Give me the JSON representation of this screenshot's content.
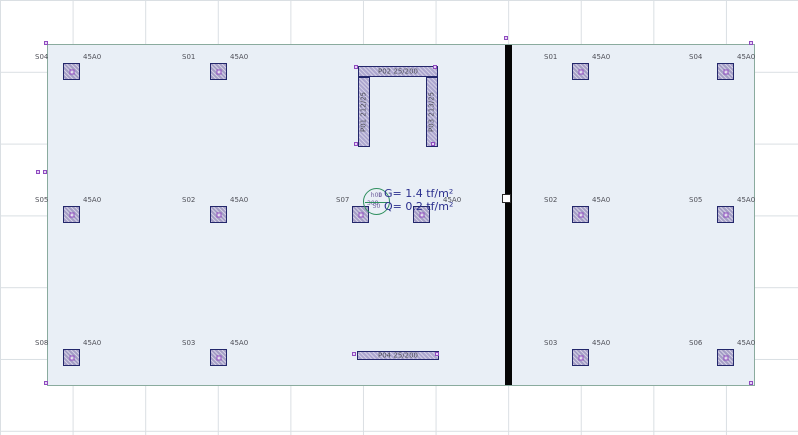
{
  "canvas": {
    "width": 798,
    "height": 435,
    "background": "#ffffff",
    "grid_color": "#dadfe3"
  },
  "slab": {
    "fill": "#e9eff6",
    "border_color": "#8aab9e"
  },
  "divider_wall": {
    "color": "#050505"
  },
  "accent_colors": {
    "entity_fill": "#a49ec6",
    "entity_border": "#23276b",
    "node_marker_purple": "#8f4bbf",
    "label_gray": "#4f5058",
    "load_text_blue": "#2b2f8e",
    "slab_tag_green": "#2e8f5e"
  },
  "loads": {
    "g": "G= 1.4 tf/m²",
    "q": "Q= 0.2 tf/m²"
  },
  "slab_tag": {
    "line1": "h00",
    "line2": "50"
  },
  "columns": [
    {
      "name": "S04",
      "section": "45A0",
      "x": 63,
      "y": 63
    },
    {
      "name": "S01",
      "section": "45A0",
      "x": 210,
      "y": 63
    },
    {
      "name": "S05",
      "section": "45A0",
      "x": 63,
      "y": 206
    },
    {
      "name": "S02",
      "section": "45A0",
      "x": 210,
      "y": 206
    },
    {
      "name": "S07",
      "section": null,
      "x": 352,
      "y": 206,
      "name_dx": -16
    },
    {
      "name": null,
      "section": "45A0",
      "x": 413,
      "y": 206,
      "section_dx": 30
    },
    {
      "name": "S08",
      "section": "45A0",
      "x": 63,
      "y": 349
    },
    {
      "name": "S03",
      "section": "45A0",
      "x": 210,
      "y": 349
    },
    {
      "name": "S01",
      "section": "45A0",
      "x": 572,
      "y": 63
    },
    {
      "name": "S04",
      "section": "45A0",
      "x": 717,
      "y": 63
    },
    {
      "name": "S02",
      "section": "45A0",
      "x": 572,
      "y": 206
    },
    {
      "name": "S05",
      "section": "45A0",
      "x": 717,
      "y": 206
    },
    {
      "name": "S03",
      "section": "45A0",
      "x": 572,
      "y": 349
    },
    {
      "name": "S06",
      "section": "45A0",
      "x": 717,
      "y": 349
    }
  ],
  "walls": [
    {
      "name": "P02 25/200",
      "x": 358,
      "y": 66,
      "w": 80,
      "h": 11,
      "orient": "h"
    },
    {
      "name": "P01 212/25",
      "x": 358,
      "y": 77,
      "w": 12,
      "h": 70,
      "orient": "v"
    },
    {
      "name": "P03 213/25",
      "x": 426,
      "y": 77,
      "w": 12,
      "h": 70,
      "orient": "v"
    },
    {
      "name": "P04 25/200",
      "x": 357,
      "y": 351,
      "w": 82,
      "h": 9,
      "orient": "h"
    }
  ],
  "markers": [
    {
      "x": 44,
      "y": 41
    },
    {
      "x": 749,
      "y": 41
    },
    {
      "x": 44,
      "y": 381
    },
    {
      "x": 749,
      "y": 381
    },
    {
      "x": 504,
      "y": 36
    },
    {
      "x": 36,
      "y": 170
    },
    {
      "x": 43,
      "y": 170
    },
    {
      "x": 354,
      "y": 65
    },
    {
      "x": 433,
      "y": 65
    },
    {
      "x": 354,
      "y": 142
    },
    {
      "x": 431,
      "y": 142
    },
    {
      "x": 352,
      "y": 352
    },
    {
      "x": 435,
      "y": 352
    }
  ],
  "texts": [
    {
      "t": "1",
      "x": 378,
      "y": 193,
      "cls": "tiny"
    },
    {
      "t": "308",
      "x": 367,
      "y": 201,
      "cls": "tiny"
    }
  ]
}
